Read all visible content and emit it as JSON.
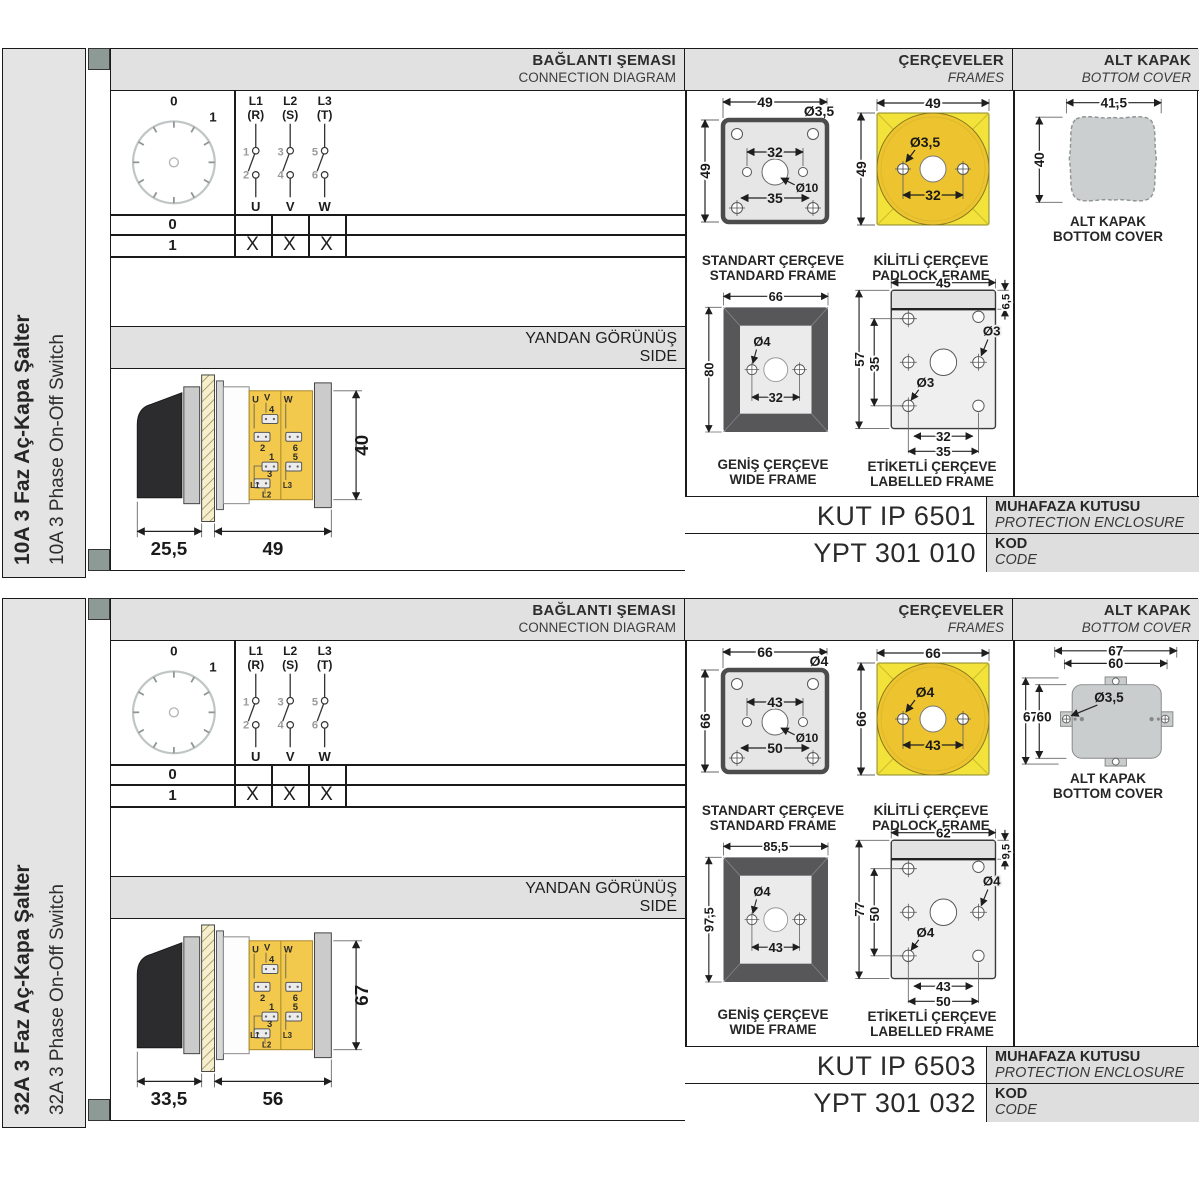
{
  "colors": {
    "accent_yellow": "#f2e23a",
    "padlock_circle": "#edc42f",
    "body_yellow": "#f3c94d",
    "frame_dark": "#57575a",
    "header_gray": "#e1e1e1",
    "tab_gray": "#8e9a95"
  },
  "panels": [
    {
      "sidebar": {
        "title_tr": "10A 3 Faz Aç-Kapa Şalter",
        "title_en": "10A 3 Phase On-Off Switch"
      },
      "headers": {
        "connection": {
          "tr": "BAĞLANTI ŞEMASI",
          "en": "CONNECTION DIAGRAM"
        },
        "frames": {
          "tr": "ÇERÇEVELER",
          "en": "FRAMES"
        },
        "cover": {
          "tr": "ALT KAPAK",
          "en": "BOTTOM COVER"
        },
        "side": {
          "tr": "YANDAN GÖRÜNÜŞ",
          "en": "SIDE"
        }
      },
      "connection": {
        "dial": {
          "off": "0",
          "on": "1"
        },
        "phases": [
          {
            "name": "L1",
            "alt": "(R)",
            "in": "1",
            "out_n": "2",
            "load": "U"
          },
          {
            "name": "L2",
            "alt": "(S)",
            "in": "3",
            "out_n": "4",
            "load": "V"
          },
          {
            "name": "L3",
            "alt": "(T)",
            "in": "5",
            "out_n": "6",
            "load": "W"
          }
        ],
        "table": {
          "rows": [
            {
              "label": "0",
              "cells": [
                "",
                "",
                ""
              ]
            },
            {
              "label": "1",
              "cells": [
                "X",
                "X",
                "X"
              ]
            }
          ]
        }
      },
      "side_view": {
        "dim_handle": "25,5",
        "dim_body": "49",
        "dim_height": "40",
        "terminals": {
          "u": "U",
          "v": "V",
          "w": "W",
          "n1": "1",
          "n2": "2",
          "n3": "3",
          "n4": "4",
          "n5": "5",
          "n6": "6",
          "l1": "L1",
          "l2": "L2",
          "l3": "L3"
        }
      },
      "frames": {
        "standard": {
          "cap_tr": "STANDART ÇERÇEVE",
          "cap_en": "STANDARD FRAME",
          "w": "49",
          "h": "49",
          "hole": "Ø3,5",
          "pitch": "32",
          "center": "Ø10",
          "slot": "35"
        },
        "padlock": {
          "cap_tr": "KİLİTLİ ÇERÇEVE",
          "cap_en": "PADLOCK FRAME",
          "w": "49",
          "h": "49",
          "hole": "Ø3,5",
          "pitch": "32"
        },
        "wide": {
          "cap_tr": "GENİŞ ÇERÇEVE",
          "cap_en": "WIDE FRAME",
          "w": "66",
          "h": "80",
          "hole": "Ø4",
          "pitch": "32"
        },
        "labelled": {
          "cap_tr": "ETİKETLİ ÇERÇEVE",
          "cap_en": "LABELLED FRAME",
          "w": "45",
          "strip": "6,5",
          "h": "57",
          "inner_h": "35",
          "hole_r": "Ø3",
          "hole_b": "Ø3",
          "pitch": "32",
          "slot": "35"
        }
      },
      "cover": {
        "cap_tr": "ALT KAPAK",
        "cap_en": "BOTTOM COVER",
        "w": "41,5",
        "h": "40"
      },
      "enclosure": {
        "value": "KUT IP 6501",
        "label_tr": "MUHAFAZA KUTUSU",
        "label_en": "PROTECTION ENCLOSURE"
      },
      "code": {
        "value": "YPT 301 010",
        "label_tr": "KOD",
        "label_en": "CODE"
      }
    },
    {
      "sidebar": {
        "title_tr": "32A 3 Faz Aç-Kapa Şalter",
        "title_en": "32A 3 Phase On-Off Switch"
      },
      "headers": {
        "connection": {
          "tr": "BAĞLANTI ŞEMASI",
          "en": "CONNECTION DIAGRAM"
        },
        "frames": {
          "tr": "ÇERÇEVELER",
          "en": "FRAMES"
        },
        "cover": {
          "tr": "ALT KAPAK",
          "en": "BOTTOM COVER"
        },
        "side": {
          "tr": "YANDAN GÖRÜNÜŞ",
          "en": "SIDE"
        }
      },
      "connection": {
        "dial": {
          "off": "0",
          "on": "1"
        },
        "phases": [
          {
            "name": "L1",
            "alt": "(R)",
            "in": "1",
            "out_n": "2",
            "load": "U"
          },
          {
            "name": "L2",
            "alt": "(S)",
            "in": "3",
            "out_n": "4",
            "load": "V"
          },
          {
            "name": "L3",
            "alt": "(T)",
            "in": "5",
            "out_n": "6",
            "load": "W"
          }
        ],
        "table": {
          "rows": [
            {
              "label": "0",
              "cells": [
                "",
                "",
                ""
              ]
            },
            {
              "label": "1",
              "cells": [
                "X",
                "X",
                "X"
              ]
            }
          ]
        }
      },
      "side_view": {
        "dim_handle": "33,5",
        "dim_body": "56",
        "dim_height": "67",
        "terminals": {
          "u": "U",
          "v": "V",
          "w": "W",
          "n1": "1",
          "n2": "2",
          "n3": "3",
          "n4": "4",
          "n5": "5",
          "n6": "6",
          "l1": "L1",
          "l2": "L2",
          "l3": "L3"
        }
      },
      "frames": {
        "standard": {
          "cap_tr": "STANDART ÇERÇEVE",
          "cap_en": "STANDARD FRAME",
          "w": "66",
          "h": "66",
          "hole": "Ø4",
          "pitch": "43",
          "center": "Ø10",
          "slot": "50"
        },
        "padlock": {
          "cap_tr": "KİLİTLİ ÇERÇEVE",
          "cap_en": "PADLOCK FRAME",
          "w": "66",
          "h": "66",
          "hole": "Ø4",
          "pitch": "43"
        },
        "wide": {
          "cap_tr": "GENİŞ ÇERÇEVE",
          "cap_en": "WIDE FRAME",
          "w": "85,5",
          "h": "97,5",
          "hole": "Ø4",
          "pitch": "43"
        },
        "labelled": {
          "cap_tr": "ETİKETLİ ÇERÇEVE",
          "cap_en": "LABELLED FRAME",
          "w": "62",
          "strip": "9,5",
          "h": "77",
          "inner_h": "50",
          "hole_r": "Ø4",
          "hole_b": "Ø4",
          "pitch": "43",
          "slot": "50"
        }
      },
      "cover": {
        "cap_tr": "ALT KAPAK",
        "cap_en": "BOTTOM COVER",
        "w_out": "67",
        "w_in": "60",
        "h_out": "67",
        "h_in": "60",
        "hole": "Ø3,5"
      },
      "enclosure": {
        "value": "KUT IP 6503",
        "label_tr": "MUHAFAZA KUTUSU",
        "label_en": "PROTECTION ENCLOSURE"
      },
      "code": {
        "value": "YPT 301 032",
        "label_tr": "KOD",
        "label_en": "CODE"
      }
    }
  ]
}
